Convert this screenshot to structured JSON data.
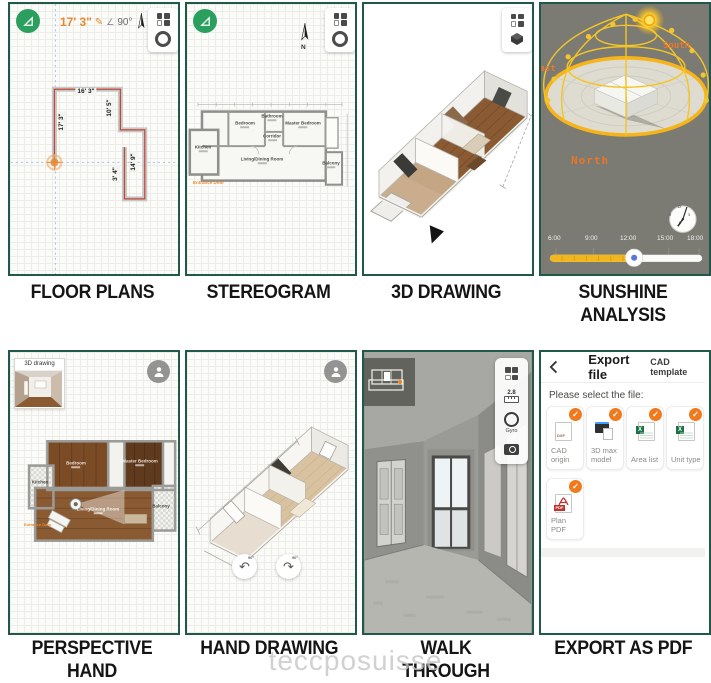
{
  "watermark": "teccposuisse",
  "captions": {
    "p1": "FLOOR PLANS",
    "p2": "STEREOGRAM",
    "p3": "3D DRAWING",
    "p4": "SUNSHINE ANALYSIS",
    "p5": "PERSPECTIVE HAND DRAWING",
    "p6": "HAND DRAWING",
    "p7": "WALK THROUGH VIEW",
    "p8": "EXPORT AS PDF"
  },
  "icons": {
    "pencil": "✎",
    "angle": "∠",
    "rotate_ccw": "↶",
    "rotate_cw": "↷",
    "check": "✓"
  },
  "floor_plans": {
    "toolbar": {
      "length": "17' 3\"",
      "angle": "90°"
    },
    "measurements": {
      "top": "16' 3\"",
      "left": "17' 3\"",
      "right_upper": "10' 5\"",
      "right_lower": "14' 9\"",
      "inner": "3' 4\""
    }
  },
  "stereogram": {
    "north": "N",
    "rooms": {
      "bedroom": "Bedroom",
      "bathroom": "Bathroom",
      "master": "Master Bedroom",
      "kitchen": "Kitchen",
      "corridor": "Corridor",
      "living": "Living/Dining Room",
      "balcony": "Balcony"
    },
    "entrance": "Entrance Door"
  },
  "sunshine": {
    "south": "South",
    "east": "East",
    "north": "North",
    "times": [
      "6:00",
      "9:00",
      "12:00",
      "15:00",
      "18:00"
    ],
    "clock": [
      "12",
      "3",
      "6",
      "9"
    ]
  },
  "perspective": {
    "inset_title": "3D drawing",
    "rooms": {
      "bedroom": "Bedroom",
      "master": "Master Bedroom",
      "kitchen": "Kitchen",
      "living": "Living/Dining Room",
      "balcony": "Balcony"
    },
    "entrance": "Entrance Door"
  },
  "hand_drawing": {
    "rotate_left": "90°",
    "rotate_right": "90°"
  },
  "walkthrough": {
    "height": "2.8",
    "gyro": "Gyro"
  },
  "export": {
    "title": "Export file",
    "subtitle": "CAD template",
    "prompt": "Please select the file:",
    "options": [
      {
        "label": "CAD origin"
      },
      {
        "label": "3D max model"
      },
      {
        "label": "Area list"
      },
      {
        "label": "Unit type"
      },
      {
        "label": "Plan PDF"
      }
    ],
    "dxf_badge": "DXF",
    "pdf_badge": "PDF"
  },
  "colors": {
    "panel_border": "#20594a",
    "accent_orange": "#e8872e",
    "slider_yellow": "#f3b71e",
    "check_orange": "#f07a1d",
    "excel_green": "#1e7145",
    "pdf_red": "#c4302b"
  }
}
